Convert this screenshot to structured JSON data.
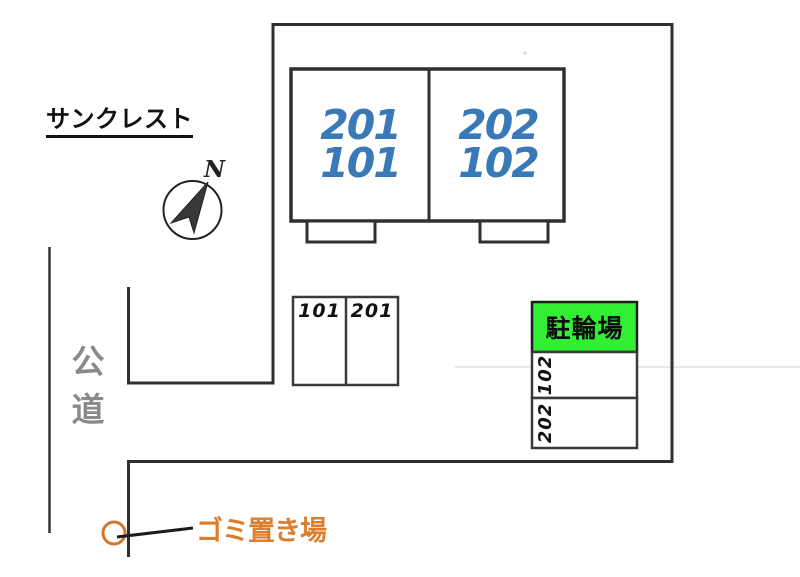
{
  "page_title": "サンクレスト",
  "compass": {
    "label": "N"
  },
  "building": {
    "units_left": {
      "upper": "201",
      "lower": "101"
    },
    "units_right": {
      "upper": "202",
      "lower": "102"
    }
  },
  "car_parking": {
    "spaces": [
      {
        "label": "101"
      },
      {
        "label": "201"
      }
    ]
  },
  "side_parking": {
    "spaces": [
      {
        "label": "102"
      },
      {
        "label": "202"
      }
    ]
  },
  "bicycle_parking": {
    "label": "駐輪場"
  },
  "road": {
    "label": "公道"
  },
  "garbage_area": {
    "label": "ゴミ置き場"
  },
  "colors": {
    "unit_number_blue": "#3a79b8",
    "bicycle_green": "#33ef33",
    "garbage_orange": "#dd7e2d",
    "road_gray": "#8a8a8a",
    "line_dark": "#2f2f2f"
  }
}
